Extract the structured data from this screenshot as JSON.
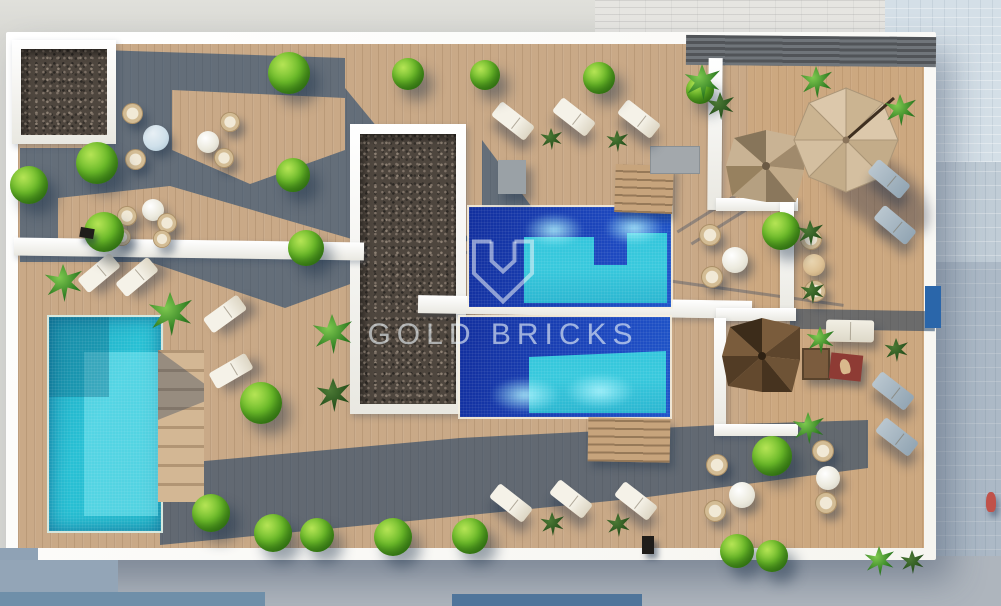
{
  "watermark": {
    "brand": "GOLD BRICKS"
  },
  "colors": {
    "deck_wood": "#c9a987",
    "parapet_white": "#f6f5f0",
    "shadow_blue": "rgba(16,62,110,0.55)",
    "pergola_shadow": "rgba(12,52,96,0.55)",
    "pool_deep": "#1d49c0",
    "pool_turquoise": "#38c9dd",
    "pool_small": "#28c0d4",
    "gravel": "#4e463e",
    "foliage": "#6cbc2a",
    "street": "#c0ccd6",
    "umbrella": "#d8c2a4",
    "sofa_table_red": "#8e3b34",
    "watermark_white": "rgba(236,243,248,0.62)"
  },
  "scene": {
    "elements": [
      "rooftop-terrace",
      "main-pool-upper",
      "main-pool-lower",
      "private-pool-left",
      "gravel-planter-square",
      "gravel-planter-long",
      "parasol",
      "spiral-staircase-upper",
      "spiral-staircase-lower",
      "sun-loungers",
      "wicker-dining-sets",
      "outdoor-sofa-set",
      "deck-shrubs",
      "palm-plants",
      "street-pavement",
      "pedestrian"
    ]
  }
}
